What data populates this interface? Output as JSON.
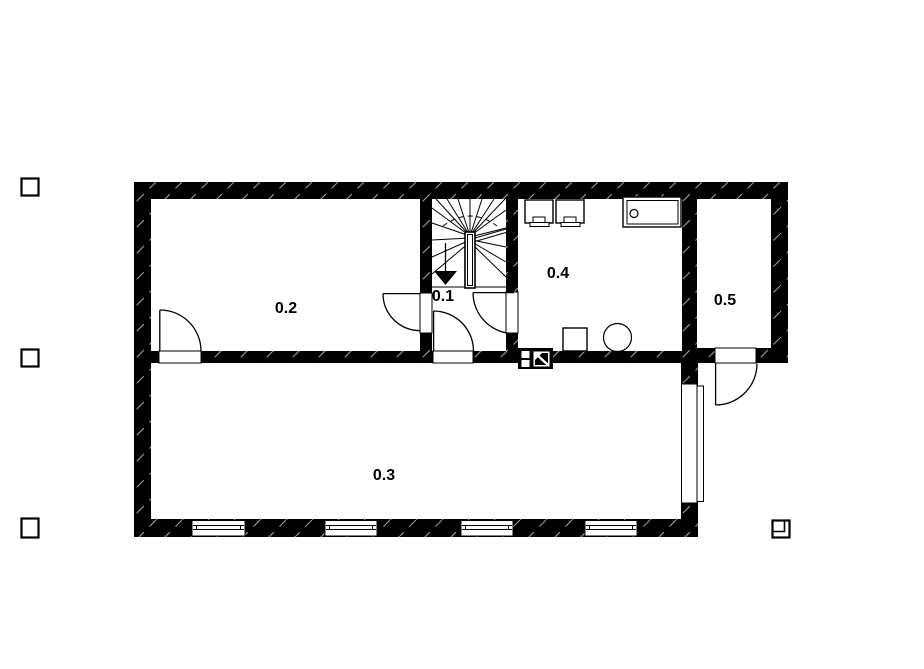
{
  "drawing": {
    "type": "architectural-floor-plan",
    "rooms": [
      {
        "id": "room-0-1",
        "label": "0.1"
      },
      {
        "id": "room-0-2",
        "label": "0.2"
      },
      {
        "id": "room-0-3",
        "label": "0.3"
      },
      {
        "id": "room-0-4",
        "label": "0.4"
      },
      {
        "id": "room-0-5",
        "label": "0.5"
      }
    ],
    "symbols": [
      "staircase-winder",
      "stair-direction-arrow",
      "door-swing",
      "window",
      "washing-machine",
      "washing-machine",
      "sink-counter",
      "chimney-flue",
      "round-fixture",
      "square-fixture",
      "registration-mark"
    ],
    "colors": {
      "wall": "#000000",
      "background": "#ffffff",
      "wall_hatch": "#9a9a9a",
      "line": "#000000"
    }
  }
}
